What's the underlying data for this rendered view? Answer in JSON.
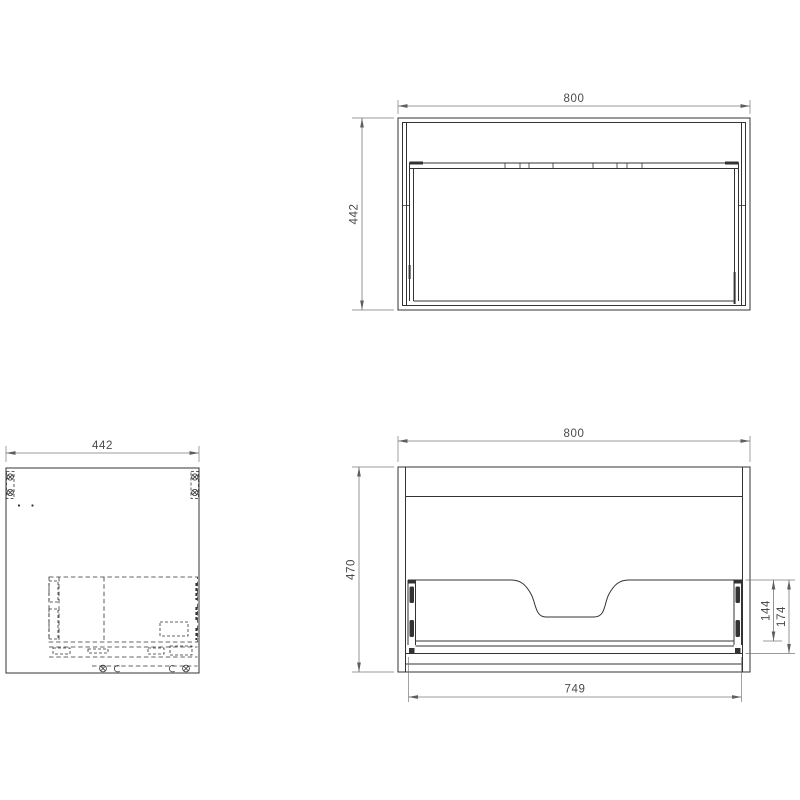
{
  "drawing": {
    "background": "#ffffff",
    "colors": {
      "line": "#333333",
      "dim_line": "#7a7a7a",
      "text": "#4a4a4a",
      "background": "#ffffff"
    },
    "plan_view": {
      "width_dim": "800",
      "depth_dim": "442"
    },
    "side_view": {
      "depth_dim": "442"
    },
    "rear_view": {
      "width_dim": "800",
      "height_dim": "470",
      "drawer_width_dim": "749",
      "drawer_back_height_dim": "144",
      "drawer_assembly_height_dim": "174"
    }
  }
}
